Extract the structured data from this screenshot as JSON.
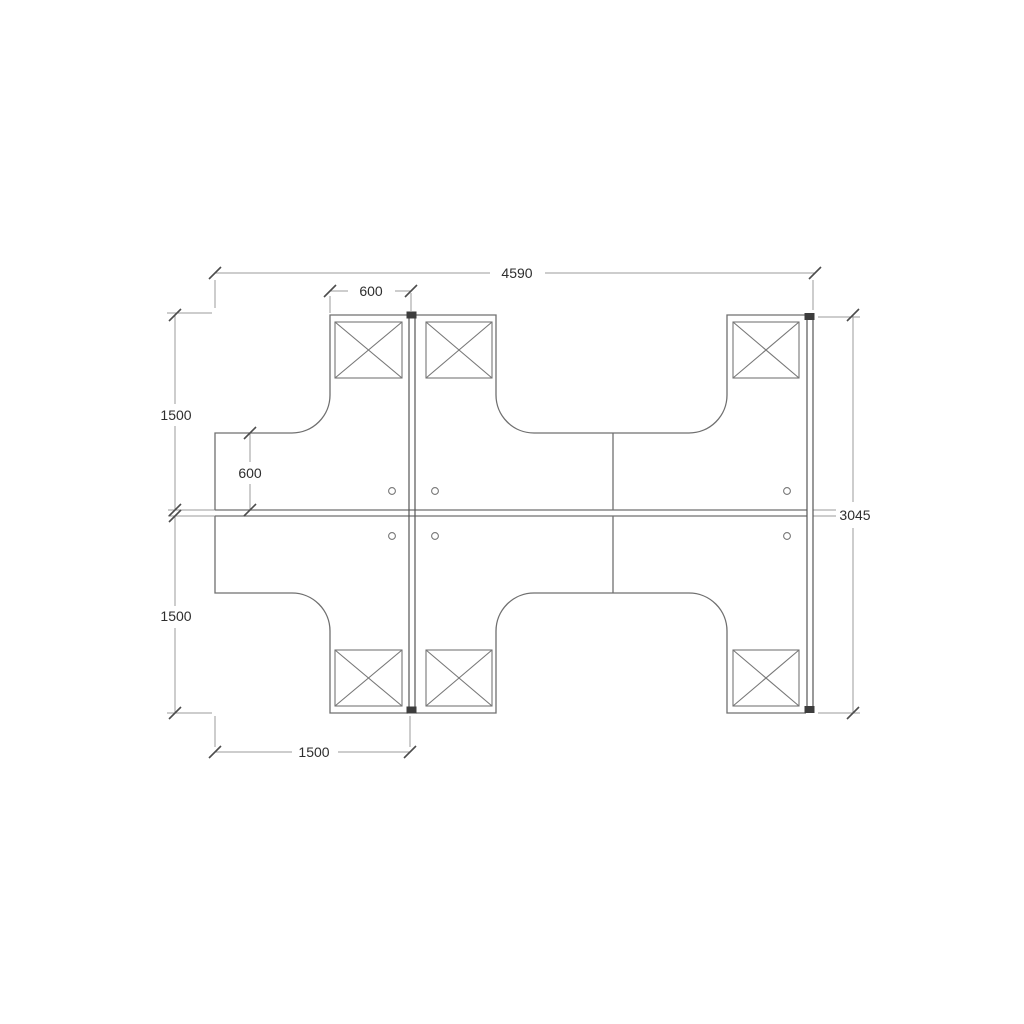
{
  "drawing": {
    "title": "desk-cluster-floor-plan",
    "labels": {
      "total_width": "4590",
      "top_segment_width": "600",
      "upper_left_depth": "1500",
      "return_depth": "600",
      "lower_left_depth": "1500",
      "overall_depth": "3045",
      "bottom_return_length": "1500"
    },
    "symbols": {
      "crossed_box_count": 6,
      "grommet_hole_count": 6
    },
    "colors": {
      "background": "#ffffff",
      "outline": "#6f6f6f",
      "dimension_line": "#9b9b9b",
      "tick": "#4c4c4c",
      "text": "#2e2e2e",
      "screen_panel": "#565656",
      "panel_cap": "#3d3d3d"
    }
  }
}
